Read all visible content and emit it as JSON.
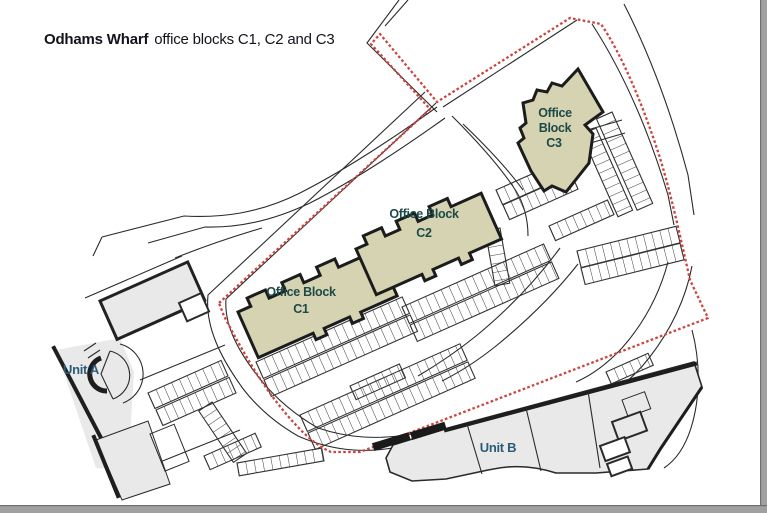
{
  "title": {
    "project": "Odhams Wharf",
    "subtitle": "office blocks C1, C2 and C3"
  },
  "blocks": {
    "c1": {
      "line1": "Office Block",
      "line2": "C1"
    },
    "c2": {
      "line1": "Office Block",
      "line2": "C2"
    },
    "c3": {
      "line1": "Office",
      "line2": "Block",
      "line3": "C3"
    }
  },
  "units": {
    "a": {
      "label": "Unit A"
    },
    "b": {
      "label": "Unit B"
    }
  },
  "colors": {
    "block_fill": "#d6d3b3",
    "block_outline": "#1c1c1c",
    "block_label": "#1d4a47",
    "unit_fill": "#e9e9e9",
    "unit_outline": "#2a2a2a",
    "unit_label": "#2b5c7a",
    "boundary_red": "#cc4440",
    "road_line": "#2b2b2b",
    "title_text": "#13131b",
    "page_border": "#a0a0a0"
  }
}
